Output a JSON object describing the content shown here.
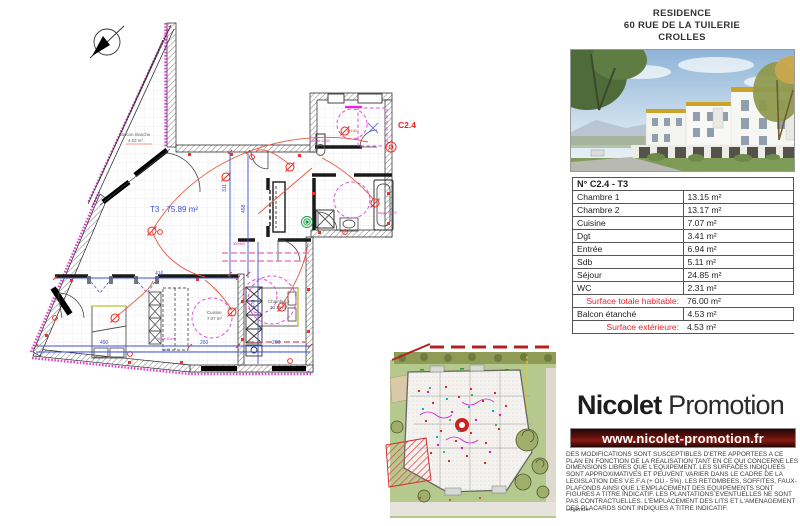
{
  "header": {
    "residence": "RESIDENCE",
    "address": "60 RUE DE LA TUILERIE",
    "city": "CROLLES"
  },
  "unit_table": {
    "title": "N° C2.4 - T3",
    "rooms": [
      {
        "label": "Chambre 1",
        "value": "13.15 m²"
      },
      {
        "label": "Chambre 2",
        "value": "13.17 m²"
      },
      {
        "label": "Cuisine",
        "value": "7.07 m²"
      },
      {
        "label": "Dgt",
        "value": "3.41 m²"
      },
      {
        "label": "Entrée",
        "value": "6.94 m²"
      },
      {
        "label": "Sdb",
        "value": "5.11 m²"
      },
      {
        "label": "Séjour",
        "value": "24.85 m²"
      },
      {
        "label": "WC",
        "value": "2.31 m²"
      }
    ],
    "total_habitable": {
      "label": "Surface totale habitable:",
      "value": "76.00 m²"
    },
    "balcony_row": {
      "label": "Balcon étanché",
      "value": "4.53 m²"
    },
    "total_exterior": {
      "label": "Surface extérieure:",
      "value": "4.53 m²"
    }
  },
  "plan": {
    "unit_area": "T3 - 75.89 m²",
    "unit_code": "C2.4",
    "balcony_name": "Balcon étanche",
    "balcony_area": "4.53 m²",
    "cuisine_name": "Cuisine",
    "cuisine_area": "7.07 m²",
    "chambre1_name": "Chambre 1",
    "chambre1_area": "13.15 m²",
    "labels": {
      "trappe": "Trappe 70x70",
      "meuble": "Meuble 40x60",
      "niche": "Niche 40x40",
      "diam130": "Ø130",
      "k600": "600x600"
    },
    "dims": {
      "d311": "311",
      "d458": "458",
      "d416": "416",
      "d470": "470",
      "d490": "490",
      "d260": "260",
      "d290": "290",
      "d1640": "1640"
    }
  },
  "brand": {
    "name_bold": "Nicolet",
    "name_light": " Promotion",
    "website": "www.nicolet-promotion.fr"
  },
  "disclaimer": "DES MODIFICATIONS SONT SUSCEPTIBLES D'ETRE APPORTEES A CE PLAN EN FONCTION DE LA REALISATION TANT EN CE QUI CONCERNE LES DIMENSIONS LIBRES QUE L'EQUIPEMENT. LES SURFACES INDIQUEES SONT APPROXIMATIVES ET PEUVENT VARIER DANS LE CADRE DE LA LEGISLATION DES V.E.F.A (+ OU - 5%). LES RETOMBEES, SOFFITES, FAUX-PLAFONDS AINSI QUE L'EMPLACEMENT DES EQUIPEMENTS SONT FIGURES A TITRE INDICATIF. LES PLANTATIONS EVENTUELLES NE SONT PAS CONTRACTUELLES. L'EMPLACEMENT DES LITS ET L'AMENAGEMENT DES PLACARDS SONT INDIQUES A TITRE INDICATIF.",
  "legend_label": "Légende:",
  "colors": {
    "note_red": "#e8242a",
    "bar_maroon": "#6e1410",
    "dim_blue": "#3d4fd0",
    "detail_magenta": "#e040d0"
  }
}
